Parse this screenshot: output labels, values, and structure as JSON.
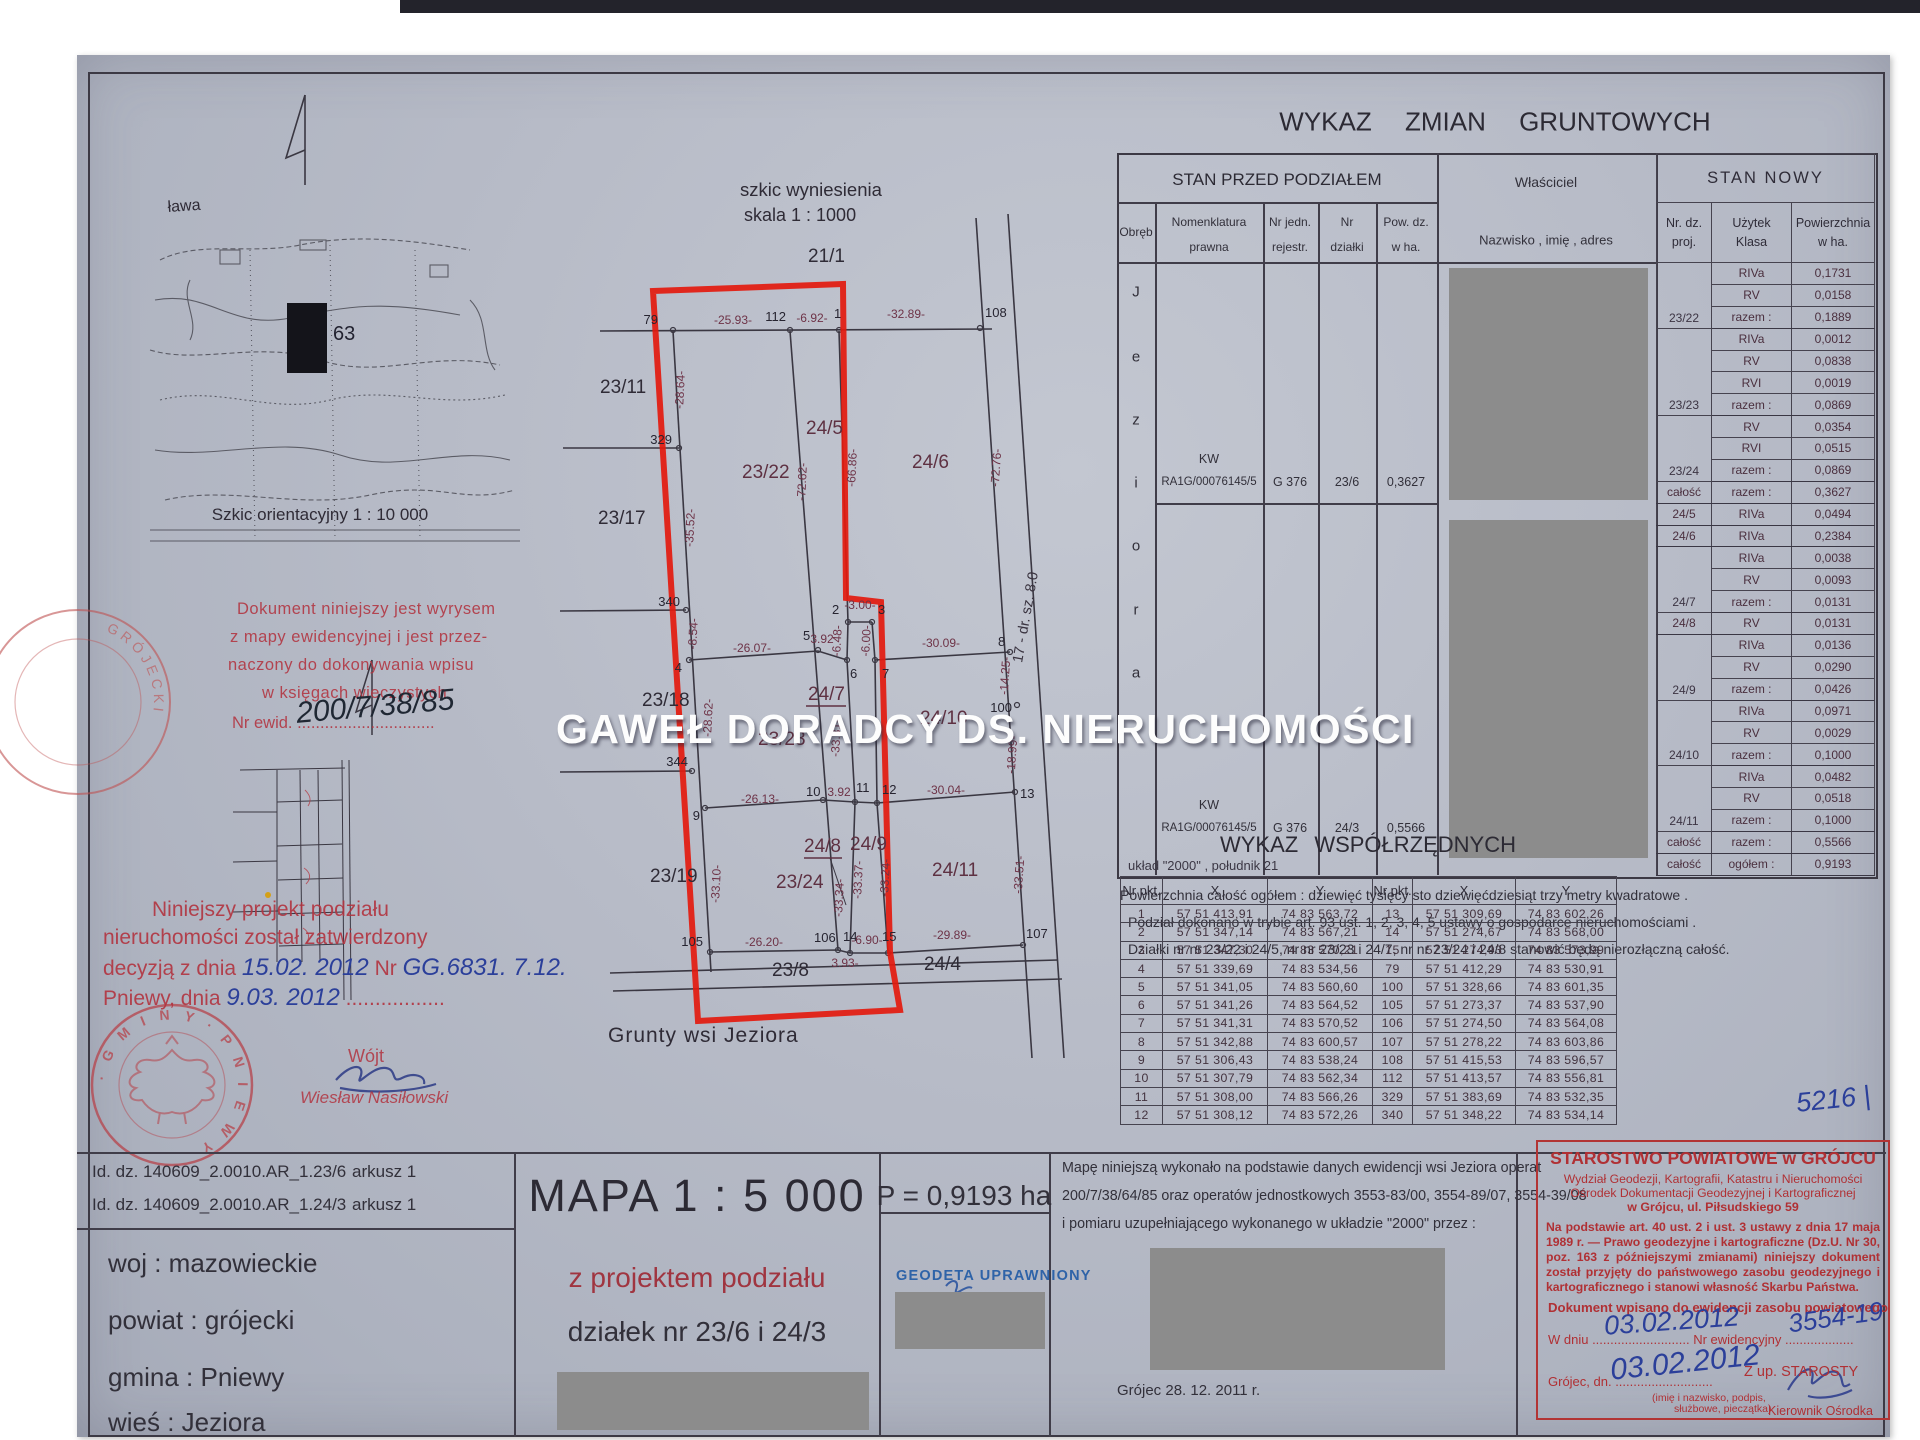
{
  "watermark": "GAWEŁ DORADCY DS. NIERUCHOMOŚCI",
  "colors": {
    "accent_red": "#e31a0e",
    "stamp_red": "#b23434",
    "handwriting_blue": "#2b3f9a",
    "redaction_gray": "#8c8c8c"
  },
  "sk": {
    "t1": "szkic wyniesienia",
    "t2": "skala 1 : 1000",
    "grunty": "Grunty wsi Jeziora",
    "road": "17 - dr. sz. 8.0",
    "parcels": [
      "21/1",
      "23/11",
      "23/17",
      "23/18",
      "23/19",
      "23/22",
      "23/23",
      "23/24",
      "24/5",
      "24/6",
      "24/7",
      "24/8",
      "24/9",
      "24/10",
      "24/11",
      "23/8",
      "24/4"
    ],
    "points": [
      "79",
      "112",
      "1",
      "108",
      "329",
      "340",
      "344",
      "4",
      "9",
      "105",
      "5",
      "6",
      "2",
      "3",
      "7",
      "10",
      "11",
      "12",
      "8",
      "100",
      "13",
      "106",
      "14",
      "15",
      "107"
    ],
    "dims": [
      "-25.93-",
      "-6.92-",
      "-32.89-",
      "-28.64-",
      "-35.52-",
      "-8.54-",
      "-72.62-",
      "-66.86-",
      "-72.76-",
      "-26.07-",
      "3.92",
      "-6.48-",
      "-3.00-",
      "-6.00-",
      "-30.09-",
      "-14.25-",
      "-18.99-",
      "-26.13-",
      "3.92",
      "-30.04-",
      "-33.10-",
      "-33.34-",
      "-33.37-",
      "-33.24-",
      "-33.51-",
      "-26.20-",
      "3.93-",
      "-6.90-",
      "-29.89-",
      "-28.62-",
      "-33.31-"
    ]
  },
  "ori": {
    "cap": "Szkic orientacyjny 1 : 10 000",
    "lbl": "ława",
    "num": "63"
  },
  "wyrys": {
    "l1": "Dokument niniejszy jest wyrysem",
    "l2": "z mapy ewidencyjnej i jest przez-",
    "l3": "naczony do dokonywania wpisu",
    "l4": "w księgach wieczystych",
    "l5": "Nr ewid. ..............................",
    "hw": "200/7/38/85"
  },
  "appr": {
    "l1": "Niniejszy projekt podziału",
    "l2": "nieruchomości został zatwierdzony",
    "l3a": "decyzją z dnia",
    "hw1": "15.02. 2012",
    "l3b": "Nr",
    "hw2": "GG.6831. 7.12.",
    "l4a": "Pniewy, dnia",
    "hw3": "9.03. 2012",
    "dots": "................."
  },
  "wojt": {
    "t": "Wójt",
    "n": "Wiesław Nasiłowski"
  },
  "seal": {
    "gmina": "· G M I N Y ·  P N I E W Y"
  },
  "seal2": {
    "grojecki": "GRÓJECKI"
  },
  "wz": {
    "title": "WYKAZ   ZMIAN   GRUNTOWYCH",
    "sp_header": "STAN PRZED PODZIAŁEM",
    "cols": {
      "obreb": "Obręb",
      "nom1": "Nomenklatura",
      "nom2": "prawna",
      "rej1": "Nr jedn.",
      "rej2": "rejestr.",
      "dz1": "Nr",
      "dz2": "działki",
      "pow1": "Pow. dz.",
      "pow2": "w ha."
    },
    "obreb_letters": [
      "J",
      "e",
      "z",
      "i",
      "o",
      "r",
      "a"
    ],
    "row1": {
      "kw": "KW",
      "nr": "RA1G/00076145/5",
      "rej": "G 376",
      "dz": "23/6",
      "pow": "0,3627"
    },
    "row2": {
      "kw": "KW",
      "nr": "RA1G/00076145/5",
      "rej": "G 376",
      "dz": "24/3",
      "pow": "0,5566"
    },
    "wl": {
      "h1": "Właściciel",
      "h2": "Nazwisko , imię , adres"
    },
    "sn": {
      "h": "STAN NOWY",
      "c1a": "Nr. dz.",
      "c1b": "proj.",
      "c2a": "Użytek",
      "c2b": "Klasa",
      "c3a": "Powierzchnia",
      "c3b": "w ha."
    },
    "rows": [
      {
        "k": "RIVa",
        "p": "0,1731"
      },
      {
        "k": "RV",
        "p": "0,0158"
      },
      {
        "n": "23/22",
        "k": "razem :",
        "p": "0,1889"
      },
      {
        "k": "RIVa",
        "p": "0,0012"
      },
      {
        "k": "RV",
        "p": "0,0838"
      },
      {
        "k": "RVI",
        "p": "0,0019"
      },
      {
        "n": "23/23",
        "k": "razem :",
        "p": "0,0869"
      },
      {
        "k": "RV",
        "p": "0,0354"
      },
      {
        "k": "RVI",
        "p": "0,0515"
      },
      {
        "n": "23/24",
        "k": "razem :",
        "p": "0,0869"
      },
      {
        "n": "całość",
        "k": "razem :",
        "p": "0,3627"
      },
      {
        "n": "24/5",
        "k": "RIVa",
        "p": "0,0494"
      },
      {
        "n": "24/6",
        "k": "RIVa",
        "p": "0,2384"
      },
      {
        "k": "RIVa",
        "p": "0,0038"
      },
      {
        "k": "RV",
        "p": "0,0093"
      },
      {
        "n": "24/7",
        "k": "razem :",
        "p": "0,0131"
      },
      {
        "n": "24/8",
        "k": "RV",
        "p": "0,0131"
      },
      {
        "k": "RIVa",
        "p": "0,0136"
      },
      {
        "k": "RV",
        "p": "0,0290"
      },
      {
        "n": "24/9",
        "k": "razem :",
        "p": "0,0426"
      },
      {
        "k": "RIVa",
        "p": "0,0971"
      },
      {
        "k": "RV",
        "p": "0,0029"
      },
      {
        "n": "24/10",
        "k": "razem :",
        "p": "0,1000"
      },
      {
        "k": "RIVa",
        "p": "0,0482"
      },
      {
        "k": "RV",
        "p": "0,0518"
      },
      {
        "n": "24/11",
        "k": "razem :",
        "p": "0,1000"
      },
      {
        "n": "całość",
        "k": "razem :",
        "p": "0,5566"
      },
      {
        "n": "całość",
        "k": "ogółem :",
        "p": "0,9193"
      }
    ]
  },
  "notes": {
    "l1": "Powierzchnia całość ogółem : dziewięć tysięcy sto dziewięćdziesiąt trzy metry kwadratowe .",
    "l2": "Podział dokonano w trybie art. 93 ust. 1, 2, 3, 4, 5 ustawy o gospodarce nieruchomościami .",
    "l3": "Działki nr nr 23/22 i 24/5, nr nr 23/23 i 24/7, nr nr 23/24 i 24/8 stanowić będą nierozłączną całość."
  },
  "coords": {
    "title": "WYKAZ  WSPÓŁRZĘDNYCH",
    "sub": "układ \"2000\" , południk 21",
    "h": {
      "n": "Nr pkt.",
      "x": "X",
      "y": "Y"
    },
    "rows": [
      {
        "n1": "1",
        "x1": "57 51 413,91",
        "y1": "74 83 563,72",
        "n2": "13",
        "x2": "57 51 309,69",
        "y2": "74 83 602,26"
      },
      {
        "n1": "2",
        "x1": "57 51 347,14",
        "y1": "74 83 567,21",
        "n2": "14",
        "x2": "57 51 274,67",
        "y2": "74 83 568,00"
      },
      {
        "n1": "3",
        "x1": "57 51 347,30",
        "y1": "74 83 570,21",
        "n2": "15",
        "x2": "57 51 274,93",
        "y2": "74 83 573,99"
      },
      {
        "n1": "4",
        "x1": "57 51 339,69",
        "y1": "74 83 534,56",
        "n2": "79",
        "x2": "57 51 412,29",
        "y2": "74 83 530,91"
      },
      {
        "n1": "5",
        "x1": "57 51 341,05",
        "y1": "74 83 560,60",
        "n2": "100",
        "x2": "57 51 328,66",
        "y2": "74 83 601,35"
      },
      {
        "n1": "6",
        "x1": "57 51 341,26",
        "y1": "74 83 564,52",
        "n2": "105",
        "x2": "57 51 273,37",
        "y2": "74 83 537,90"
      },
      {
        "n1": "7",
        "x1": "57 51 341,31",
        "y1": "74 83 570,52",
        "n2": "106",
        "x2": "57 51 274,50",
        "y2": "74 83 564,08"
      },
      {
        "n1": "8",
        "x1": "57 51 342,88",
        "y1": "74 83 600,57",
        "n2": "107",
        "x2": "57 51 278,22",
        "y2": "74 83 603,86"
      },
      {
        "n1": "9",
        "x1": "57 51 306,43",
        "y1": "74 83 538,24",
        "n2": "108",
        "x2": "57 51 415,53",
        "y2": "74 83 596,57"
      },
      {
        "n1": "10",
        "x1": "57 51 307,79",
        "y1": "74 83 562,34",
        "n2": "112",
        "x2": "57 51 413,57",
        "y2": "74 83 556,81"
      },
      {
        "n1": "11",
        "x1": "57 51 308,00",
        "y1": "74 83 566,26",
        "n2": "329",
        "x2": "57 51 383,69",
        "y2": "74 83 532,35"
      },
      {
        "n1": "12",
        "x1": "57 51 308,12",
        "y1": "74 83 572,26",
        "n2": "340",
        "x2": "57 51 348,22",
        "y2": "74 83 534,14"
      }
    ]
  },
  "foot": {
    "id1": "Id. dz. 140609_2.0010.AR_1.23/6",
    "ark1": "arkusz 1",
    "id2": "Id. dz. 140609_2.0010.AR_1.24/3",
    "ark2": "arkusz 1",
    "woj": "woj : mazowieckie",
    "powiat": "powiat : grójecki",
    "gmina": "gmina : Pniewy",
    "wies": "wieś : Jeziora",
    "mapa": "MAPA 1 : 5 000",
    "sub_red": "z projektem podziału",
    "sub2": "działek nr 23/6 i 24/3",
    "area": "P = 0,9193 ha",
    "geodeta": "GEODETA UPRAWNIONY",
    "n1": "Mapę niniejszą wykonało na podstawie danych ewidencji wsi Jeziora operat",
    "n2": "200/7/38/64/85 oraz operatów jednostkowych 3553-83/00, 3554-89/07, 3554-39/08",
    "n3": "i pomiaru uzupełniającego wykonanego w układzie \"2000\" przez :",
    "date": "Grójec 28. 12. 2011 r."
  },
  "st": {
    "l1": "STAROSTWO POWIATOWE w GRÓJCU",
    "l2": "Wydział Geodezji, Kartografii, Katastru i Nieruchomości",
    "l3": "Ośrodek Dokumentacji Geodezyjnej i Kartograficznej",
    "l4": "w Grójcu, ul. Piłsudskiego 59",
    "p1": "Na podstawie art. 40 ust. 2 i ust. 3 ustawy z dnia 17 maja 1989 r. — Prawo geodezyjne i kartograficzne (Dz.U. Nr 30, poz. 163 z późniejszymi zmianami) niniejszy dokument został przyjęty do państwowego zasobu geodezyjnego i kartograficznego i stanowi własność Skarbu Państwa.",
    "l5": "Dokument wpisano do ewidencji zasobu powiatowego",
    "l6": "W dniu ........................... Nr ewidencyjny ...................",
    "hw1": "03.02.2012",
    "hw2": "3554-19",
    "l7": "Grójec, dn. ...........................",
    "zup": "Z up. STAROSTY",
    "hw3": "03.02.2012",
    "l8": "(imię i nazwisko, podpis,",
    "l9": "służbowe, pieczątka)",
    "l10": "Kierownik Ośrodka",
    "hw_top": "5216 |"
  }
}
